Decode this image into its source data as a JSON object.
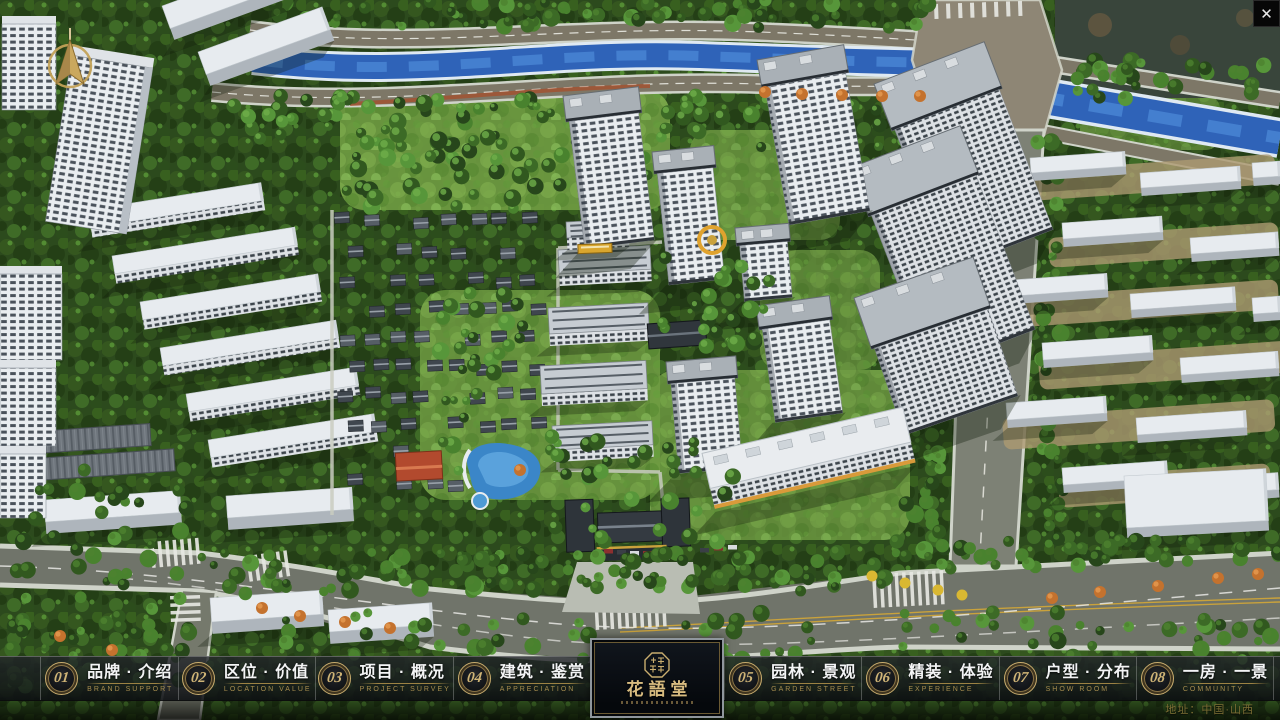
{
  "window": {
    "close_label": "✕"
  },
  "scene": {
    "compass_icon": "north-compass",
    "address": "地址：中国·山西"
  },
  "logo": {
    "seal_icon": "octagonal-seal",
    "title": "花語堂"
  },
  "nav": {
    "items": [
      {
        "num": "01",
        "label": "品牌 · 介绍",
        "caption": "BRAND SUPPORT"
      },
      {
        "num": "02",
        "label": "区位 · 价值",
        "caption": "LOCATION VALUE"
      },
      {
        "num": "03",
        "label": "项目 · 概况",
        "caption": "PROJECT SURVEY"
      },
      {
        "num": "04",
        "label": "建筑 · 鉴赏",
        "caption": "APPRECIATION"
      },
      {
        "num": "05",
        "label": "园林 · 景观",
        "caption": "GARDEN STREET"
      },
      {
        "num": "06",
        "label": "精装 · 体验",
        "caption": "EXPERIENCE"
      },
      {
        "num": "07",
        "label": "户型 · 分布",
        "caption": "SHOW ROOM"
      },
      {
        "num": "08",
        "label": "一房 · 一景",
        "caption": "COMMUNITY"
      }
    ]
  }
}
